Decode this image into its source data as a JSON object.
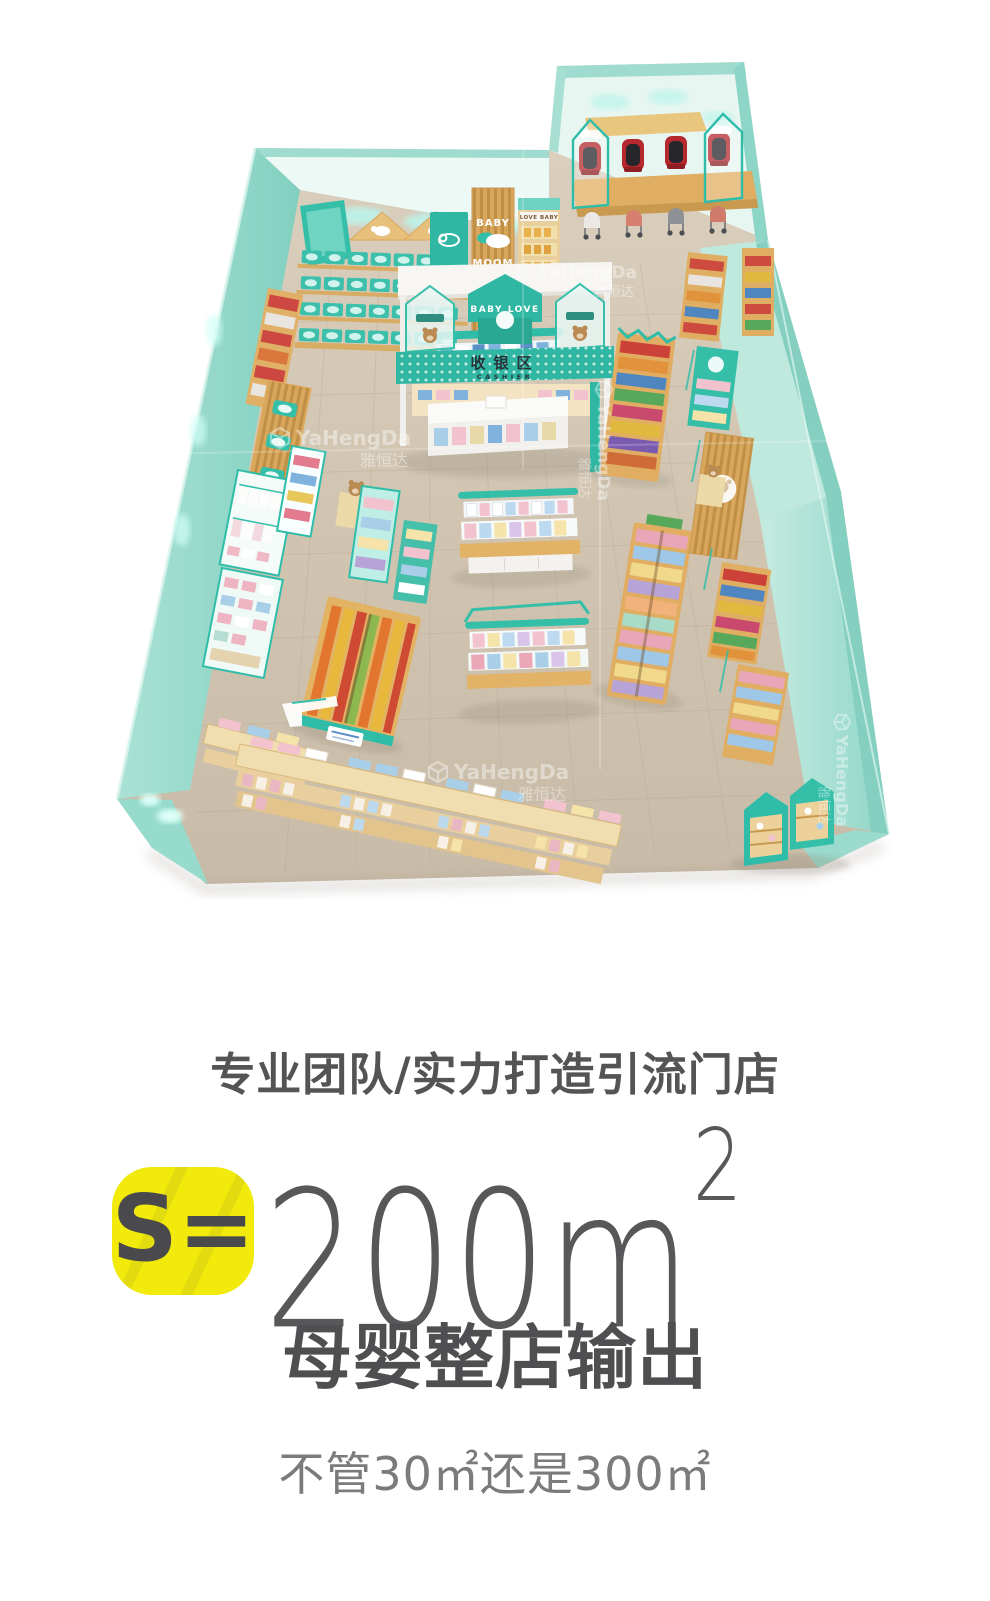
{
  "render": {
    "watermark": {
      "brand": "YaHengDa",
      "brand_cn": "雅恒达"
    },
    "signs": {
      "baby_love": "BABY LOVE",
      "cashier_cn": "收银区",
      "cashier_en": "CASHIER",
      "baby": "BABY",
      "moom": "MOOM",
      "love_baby": "LOVE BABY"
    },
    "colors": {
      "wall_teal": "#8fd6c8",
      "wall_light": "#eaf8f4",
      "floor": "#cfc3b0",
      "shelf_teal": "#2fb7a3",
      "wood": "#e0ae62",
      "accent_red": "#b5282e",
      "badge_yellow": "#f1ea0b",
      "text_dark": "#545457",
      "text_mid": "#58585a",
      "text_light": "#7b7b7e"
    }
  },
  "info": {
    "heading": "专业团队/实力打造引流门店",
    "badge": {
      "label": "S="
    },
    "area": {
      "value": "200m",
      "sup": "2"
    },
    "title": "母婴整店输出",
    "subtitle": "不管30㎡还是300㎡"
  }
}
